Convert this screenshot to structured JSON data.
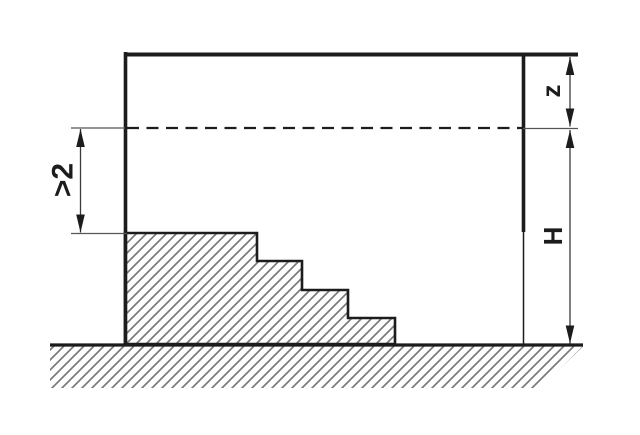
{
  "diagram": {
    "type": "technical-drawing",
    "description": "Cross-section of a stepped excavation beside a wall, with a dashed level line, hatched soil, and vertical dimension lines",
    "labels": {
      "left_dim": ">2",
      "z": "z",
      "h": "H"
    },
    "colors": {
      "outline": "#1c1c1c",
      "hatch": "#7a7a7a",
      "dim-line": "#3a3a3a",
      "ext-line": "#555555",
      "background": "#ffffff"
    }
  }
}
